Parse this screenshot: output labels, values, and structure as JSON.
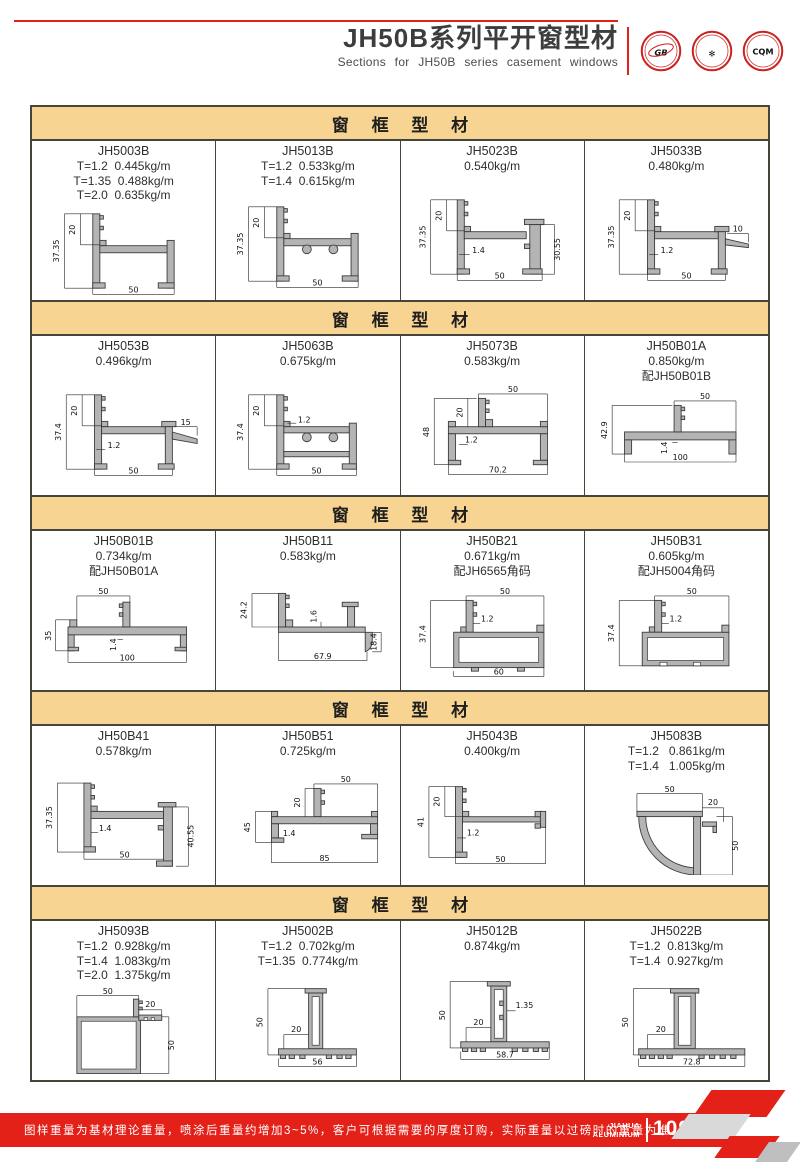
{
  "page": {
    "header": {
      "title": "JH50B系列平开窗型材",
      "subtitle": "Sections for JH50B series casement windows"
    },
    "logos": [
      {
        "name": "gb-certification",
        "text": "GB"
      },
      {
        "name": "quality-certification",
        "text": "✻"
      },
      {
        "name": "cqm-certification",
        "text": "CQM"
      }
    ],
    "footer": {
      "note": "图样重量为基材理论重量，喷涂后重量约增加3~5%，客户可根据需要的厚度订购，实际重量以过磅时的重量为准。",
      "brand_line1": "JIAHUA",
      "brand_line2": "ALUMINIUM",
      "page_number": "109"
    },
    "colors": {
      "accent_red": "#e32119",
      "section_header_tan": "#f7d492",
      "border_dark": "#45453c",
      "profile_gray": "#b4b4b4"
    }
  },
  "sections": [
    {
      "title": "窗 框 型 材",
      "cells": [
        {
          "code": "JH5003B",
          "specs": [
            "T=1.2  0.445kg/m",
            "T=1.35  0.488kg/m",
            "T=2.0  0.635kg/m"
          ],
          "dims": {
            "h": "37.35",
            "h2": "20",
            "w": "50"
          }
        },
        {
          "code": "JH5013B",
          "specs": [
            "T=1.2  0.533kg/m",
            "T=1.4  0.615kg/m"
          ],
          "dims": {
            "h": "37.35",
            "h2": "20",
            "w": "50"
          }
        },
        {
          "code": "JH5023B",
          "specs": [
            "0.540kg/m"
          ],
          "dims": {
            "h": "37.35",
            "h2": "20",
            "t": "1.4",
            "r": "30.55",
            "w": "50"
          }
        },
        {
          "code": "JH5033B",
          "specs": [
            "0.480kg/m"
          ],
          "dims": {
            "h": "37.35",
            "h2": "20",
            "t": "1.2",
            "fin": "10",
            "w": "50"
          }
        }
      ]
    },
    {
      "title": "窗 框 型 材",
      "cells": [
        {
          "code": "JH5053B",
          "specs": [
            "0.496kg/m"
          ],
          "dims": {
            "h": "37.4",
            "h2": "20",
            "t": "1.2",
            "fin": "15",
            "w": "50"
          }
        },
        {
          "code": "JH5063B",
          "specs": [
            "0.675kg/m"
          ],
          "dims": {
            "h": "37.4",
            "h2": "20",
            "t": "1.2",
            "w": "50"
          }
        },
        {
          "code": "JH5073B",
          "specs": [
            "0.583kg/m"
          ],
          "dims": {
            "top": "50",
            "h": "48",
            "h2": "20",
            "t": "1.2",
            "w": "70.2"
          }
        },
        {
          "code": "JH50B01A",
          "specs": [
            "0.850kg/m",
            "配JH50B01B"
          ],
          "dims": {
            "top": "50",
            "h": "42.9",
            "t": "1.4",
            "w": "100"
          }
        }
      ]
    },
    {
      "title": "窗 框 型 材",
      "cells": [
        {
          "code": "JH50B01B",
          "specs": [
            "0.734kg/m",
            "配JH50B01A"
          ],
          "dims": {
            "top": "50",
            "h": "35",
            "t": "1.4",
            "w": "100"
          }
        },
        {
          "code": "JH50B11",
          "specs": [
            "0.583kg/m"
          ],
          "dims": {
            "h": "24.2",
            "t": "1.6",
            "r": "18.4",
            "w": "67.9"
          }
        },
        {
          "code": "JH50B21",
          "specs": [
            "0.671kg/m",
            "配JH6565角码"
          ],
          "dims": {
            "top": "50",
            "h": "37.4",
            "t": "1.2",
            "w": "60"
          }
        },
        {
          "code": "JH50B31",
          "specs": [
            "0.605kg/m",
            "配JH5004角码"
          ],
          "dims": {
            "top": "50",
            "h": "37.4",
            "t": "1.2"
          }
        }
      ]
    },
    {
      "title": "窗 框 型 材",
      "cells": [
        {
          "code": "JH50B41",
          "specs": [
            "0.578kg/m"
          ],
          "dims": {
            "h": "37.35",
            "t": "1.4",
            "r": "40.55",
            "w": "50"
          }
        },
        {
          "code": "JH50B51",
          "specs": [
            "0.725kg/m"
          ],
          "dims": {
            "top": "50",
            "h": "45",
            "h2": "20",
            "t": "1.4",
            "w": "85"
          }
        },
        {
          "code": "JH5043B",
          "specs": [
            "0.400kg/m"
          ],
          "dims": {
            "h": "41",
            "h2": "20",
            "t": "1.2",
            "w": "50"
          }
        },
        {
          "code": "JH5083B",
          "specs": [
            "T=1.2   0.861kg/m",
            "T=1.4   1.005kg/m"
          ],
          "dims": {
            "top": "50",
            "h2": "20",
            "r": "50"
          }
        }
      ]
    },
    {
      "title": "窗 框 型 材",
      "cells": [
        {
          "code": "JH5093B",
          "specs": [
            "T=1.2  0.928kg/m",
            "T=1.4  1.083kg/m",
            "T=2.0  1.375kg/m"
          ],
          "dims": {
            "top": "50",
            "h2": "20",
            "r": "50"
          }
        },
        {
          "code": "JH5002B",
          "specs": [
            "T=1.2  0.702kg/m",
            "T=1.35  0.774kg/m"
          ],
          "dims": {
            "h": "50",
            "h2": "20",
            "w": "56"
          }
        },
        {
          "code": "JH5012B",
          "specs": [
            "0.874kg/m"
          ],
          "dims": {
            "h": "50",
            "h2": "20",
            "t": "1.35",
            "w": "58.7"
          }
        },
        {
          "code": "JH5022B",
          "specs": [
            "T=1.2  0.813kg/m",
            "T=1.4  0.927kg/m"
          ],
          "dims": {
            "h": "50",
            "h2": "20",
            "w": "72.8"
          }
        }
      ]
    }
  ]
}
